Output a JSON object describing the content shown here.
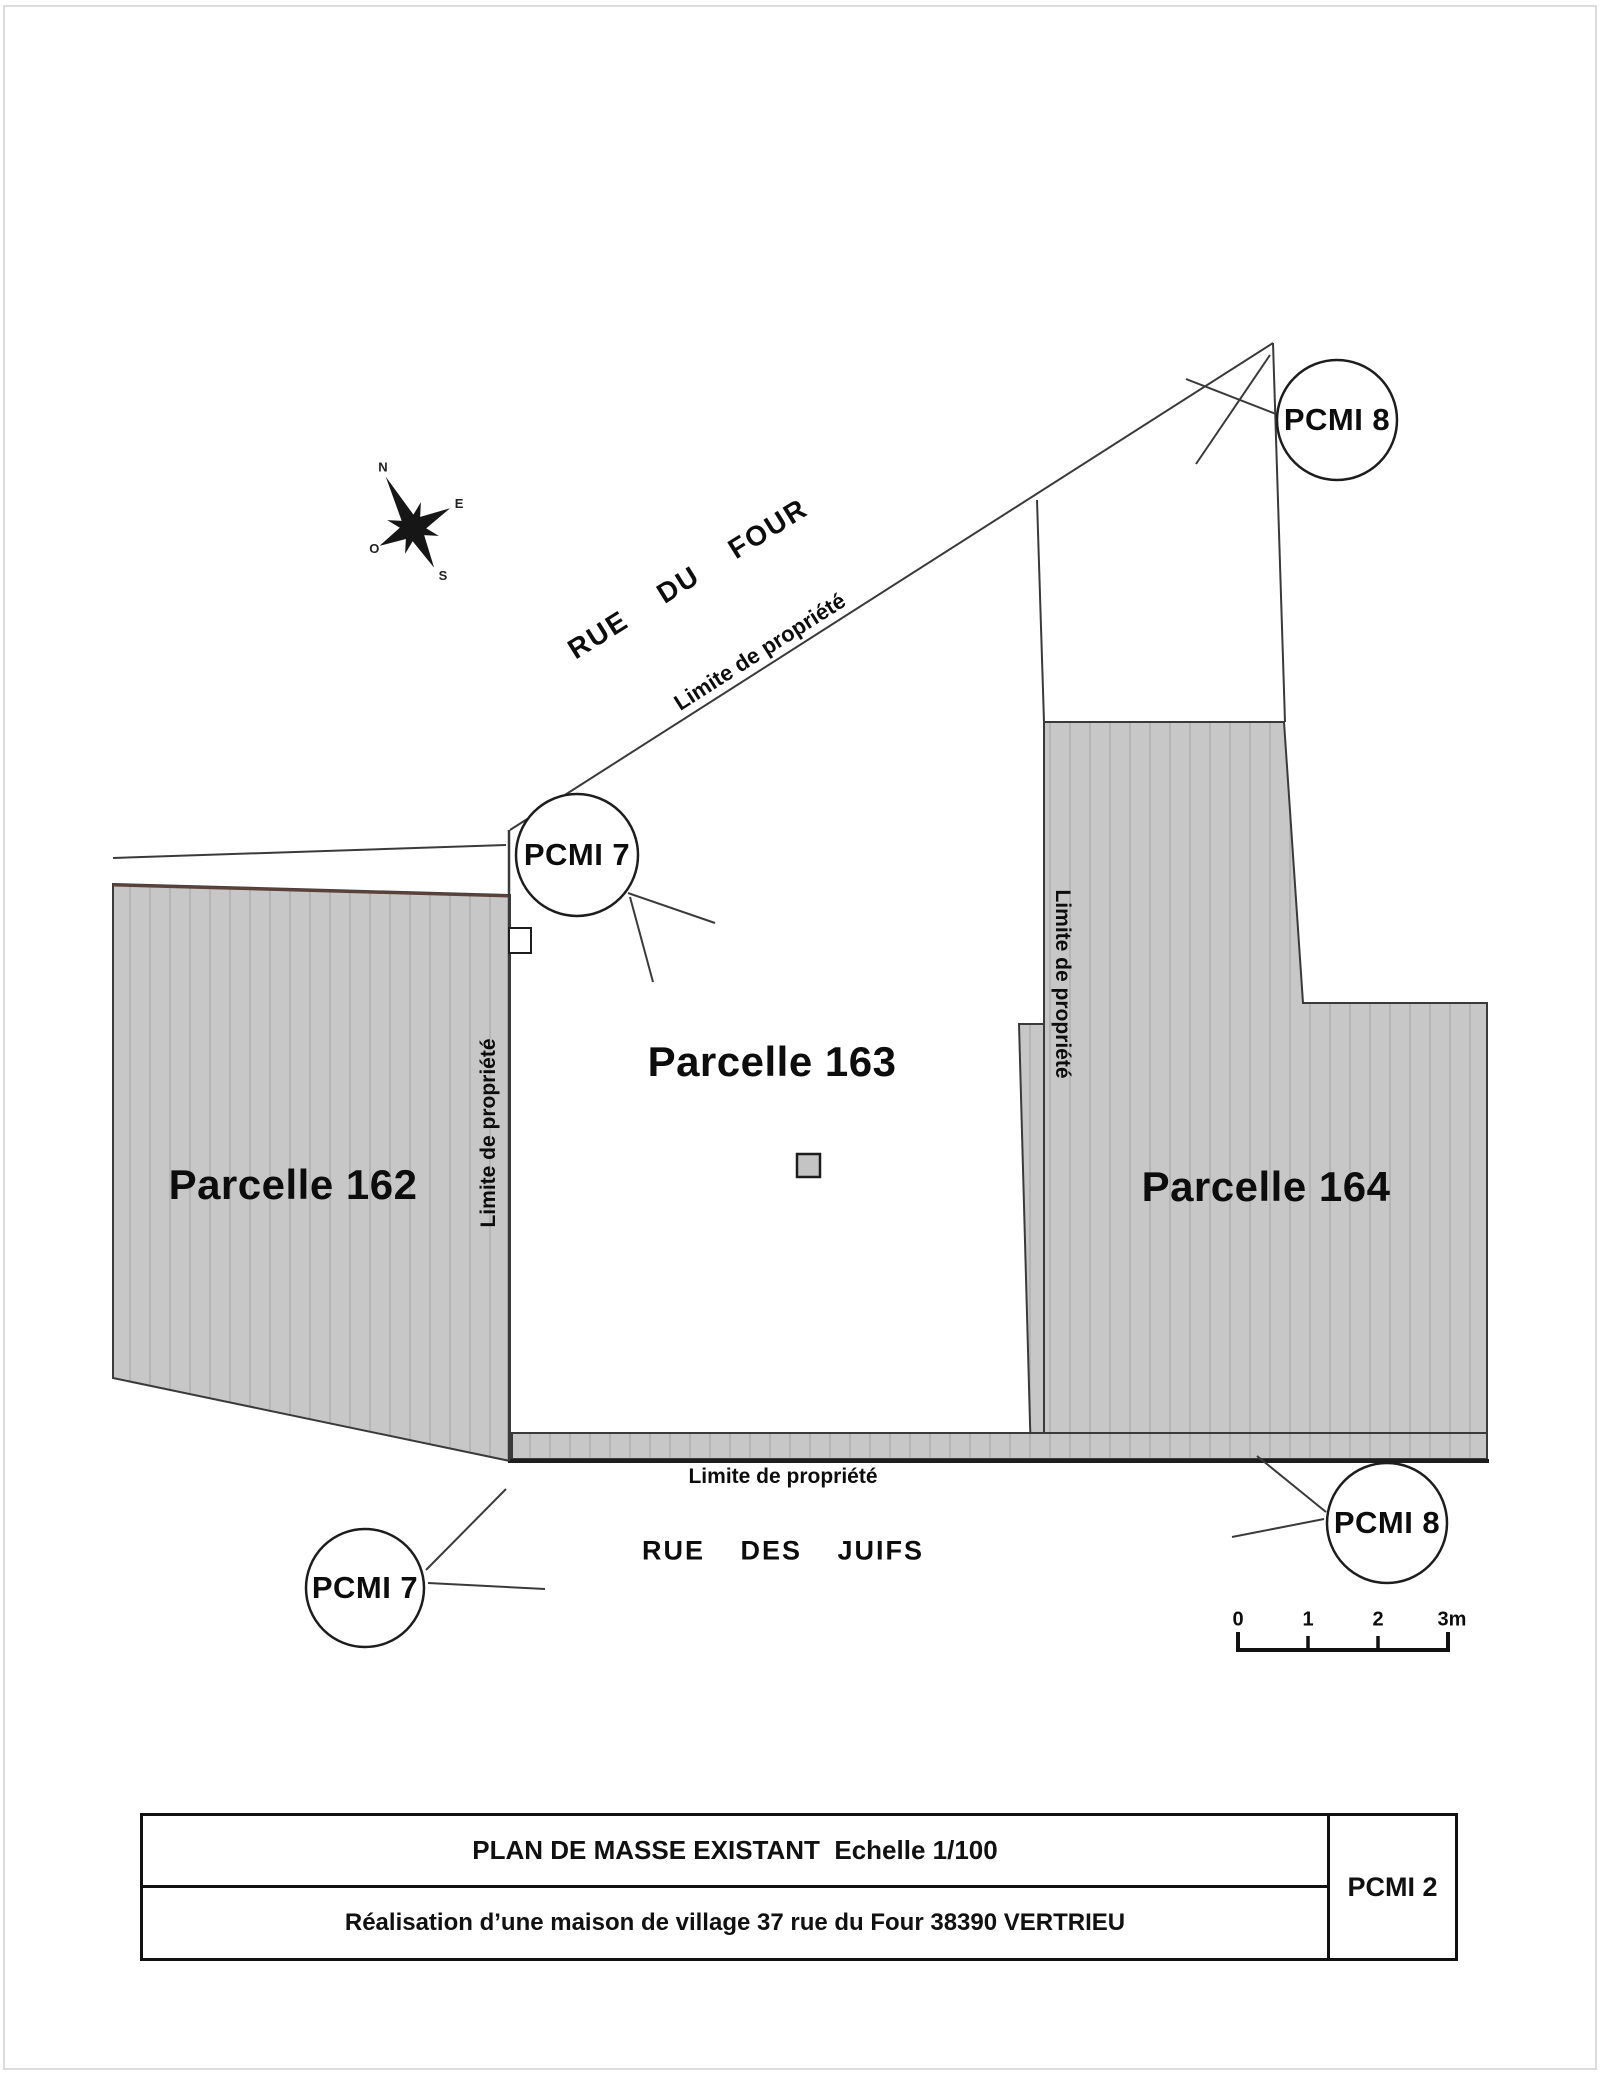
{
  "compass": {
    "n": "N",
    "e": "E",
    "s": "S",
    "o": "O"
  },
  "streets": {
    "rue_du_four": "RUE DU FOUR",
    "rue_des_juifs": "RUE DES JUIFS"
  },
  "boundaries": {
    "limite_diagonale": "Limite de propriété",
    "limite_gauche": "Limite de propriété",
    "limite_centrale": "Limite de propriété",
    "limite_basse": "Limite de propriété"
  },
  "parcels": {
    "p162": "Parcelle 162",
    "p163": "Parcelle 163",
    "p164": "Parcelle 164"
  },
  "markers": {
    "pcmi7_haut": "PCMI 7",
    "pcmi8_haut": "PCMI 8",
    "pcmi7_bas": "PCMI 7",
    "pcmi8_bas": "PCMI 8"
  },
  "scalebar": {
    "ticks": [
      "0",
      "1",
      "2",
      "3m"
    ]
  },
  "titleblock": {
    "title": "PLAN DE MASSE EXISTANT  Echelle 1/100",
    "subtitle": "Réalisation d’une maison de village 37 rue du Four 38390 VERTRIEU",
    "ref": "PCMI 2"
  },
  "colors": {
    "hatch_base": "#c7c7c7",
    "hatch_line": "#b5b5b5",
    "line": "#3a3a3a",
    "line_dark": "#1d1d1d",
    "maroon_edge": "#5a413a",
    "frame": "#dcdcdc"
  }
}
